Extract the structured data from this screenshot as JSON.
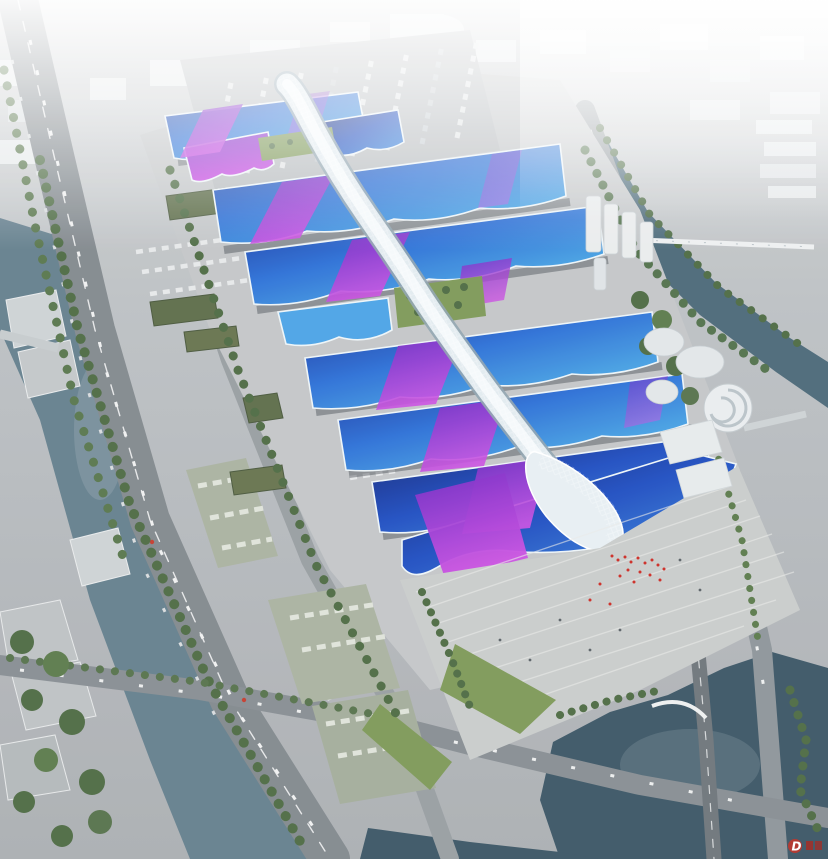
{
  "meta": {
    "type": "aerial-architectural-rendering",
    "subject": "exhibition-convention-center-complex",
    "view": "birds-eye-perspective",
    "description": "Rendering of a vast exhibition center: parallel hall rows with blue wave roofs crossed by purple ribbons, a sinuous white quilted central concourse spine ending in a flared head at the south entrance plaza, flanked by an elevated riverside expressway, canals, a lake and a hazy white cityscape"
  },
  "palette": {
    "ground": "#b4b8bb",
    "apron": "#c3c6c8",
    "plaza": "#c9cccb",
    "road_major": "#81888d",
    "road_minor": "#979da1",
    "river": "#647f8d",
    "lake": "#3a5565",
    "canal": "#4a6878",
    "roof_blue_deep": "#15309a",
    "roof_blue": "#2b6fd6",
    "roof_cyan": "#55bdea",
    "roof_navy": "#13246f",
    "ribbon_purple": "#8a33cc",
    "ribbon_magenta": "#c75fe3",
    "spine_white": "#e2ebf0",
    "trim_white": "#eef5f8",
    "lawn": "#7d9857",
    "tree": "#4c6a42",
    "green_roof": "#5c6c48",
    "building_white": "#e9eced",
    "people_red": "#cc2a22",
    "watermark_red": "#c0372e",
    "fog": "#ffffff"
  },
  "complex": {
    "hall_bands": 7,
    "top_cluster_halls": 4,
    "green_roof_strips": 2,
    "spine": "central-concourse-spine",
    "entrance": "south-entrance-hall",
    "plaza": "entrance-plaza-with-crowd"
  },
  "context": {
    "left": "elevated riverside expressway, tree lines, truck and bus parking",
    "right": "canal with long footbridge, white mid-rise city, spiral pavilion",
    "top": "cityscape fading into haze, large truck marshalling yard",
    "bottom": "lake, bridge roads, intersection and waterfront greenery"
  },
  "watermark": {
    "letter": "D",
    "color": "#c0372e"
  }
}
